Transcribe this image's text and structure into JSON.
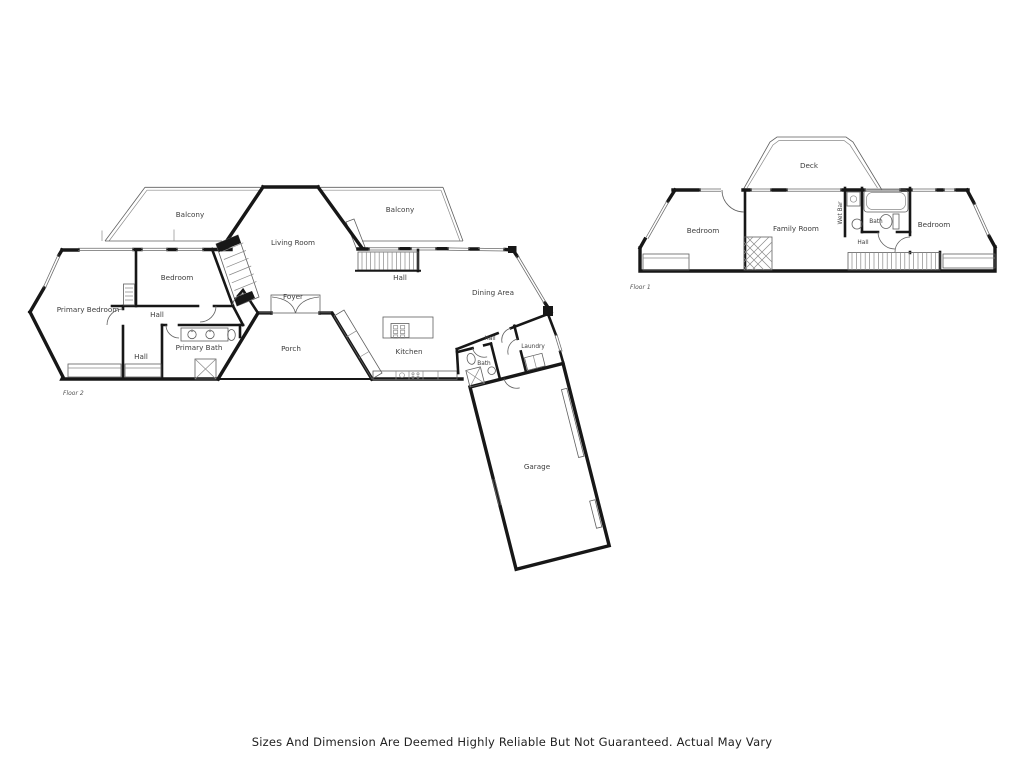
{
  "footer": {
    "disclaimer": "Sizes And Dimension Are Deemed Highly Reliable But Not Guaranteed. Actual May Vary"
  },
  "floor2": {
    "floor_label": "Floor 2",
    "rooms": {
      "balcony_left": "Balcony",
      "balcony_right": "Balcony",
      "living_room": "Living Room",
      "bedroom": "Bedroom",
      "primary_bedroom": "Primary Bedroom",
      "hall_upper": "Hall",
      "hall_lower": "Hall",
      "hall_mid": "Hall",
      "hall_bath": "Hall",
      "primary_bath": "Primary Bath",
      "foyer": "Foyer",
      "porch": "Porch",
      "dining_area": "Dining Area",
      "kitchen": "Kitchen",
      "laundry": "Laundry",
      "bath": "Bath",
      "garage": "Garage"
    }
  },
  "floor1": {
    "floor_label": "Floor 1",
    "rooms": {
      "deck": "Deck",
      "bedroom_left": "Bedroom",
      "family_room": "Family Room",
      "wet_bar": "Wet Bar",
      "bath": "Bath",
      "hall": "Hall",
      "bedroom_right": "Bedroom"
    }
  }
}
